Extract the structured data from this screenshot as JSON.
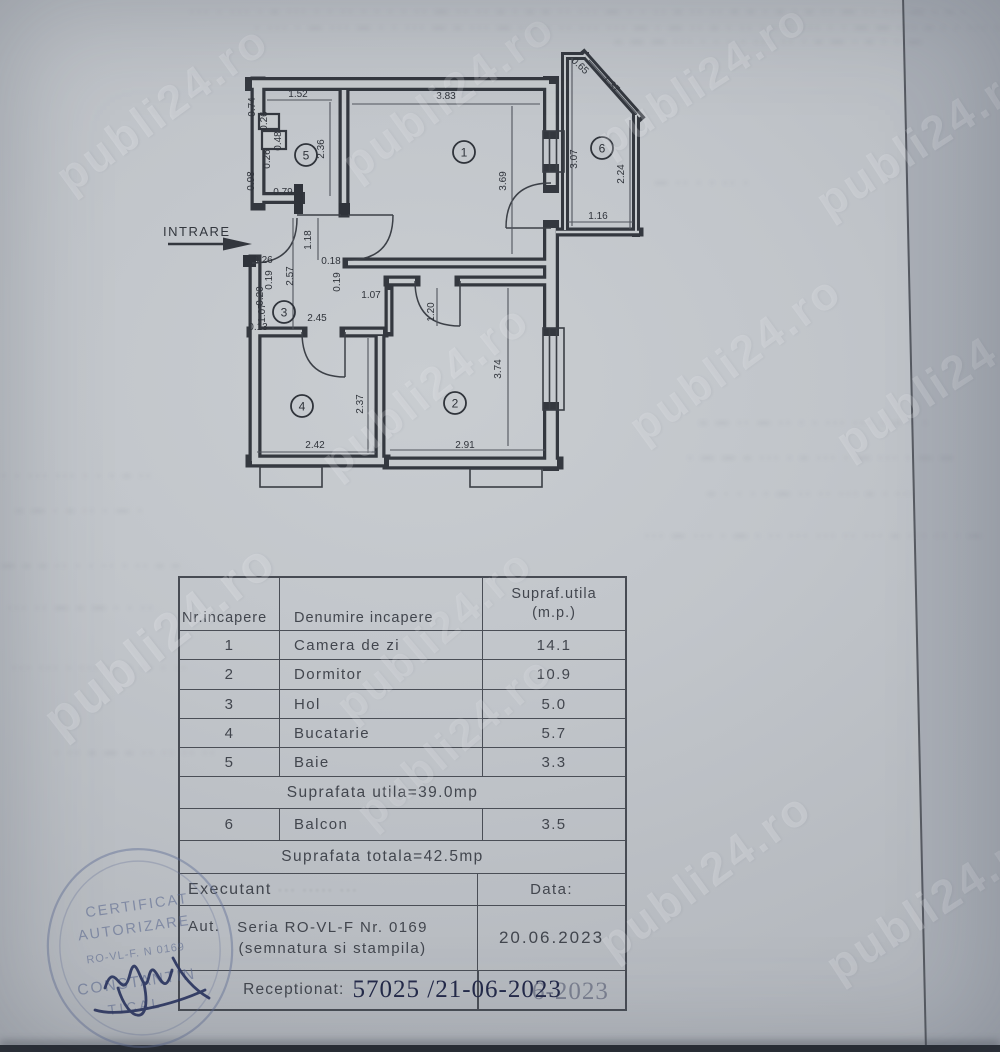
{
  "watermark": {
    "text": "publi24.ro"
  },
  "plan": {
    "entrance_label": "INTRARE",
    "room_circles": [
      {
        "label": "1",
        "x": 464,
        "y": 152
      },
      {
        "label": "2",
        "x": 455,
        "y": 403
      },
      {
        "label": "3",
        "x": 284,
        "y": 312
      },
      {
        "label": "4",
        "x": 302,
        "y": 406
      },
      {
        "label": "5",
        "x": 306,
        "y": 155
      },
      {
        "label": "6",
        "x": 602,
        "y": 148
      }
    ],
    "dim_labels": [
      {
        "t": "1.52",
        "x": 298,
        "y": 97,
        "r": 0
      },
      {
        "t": "0.74",
        "x": 255,
        "y": 107,
        "r": -90
      },
      {
        "t": "0.26",
        "x": 267,
        "y": 121,
        "r": -90
      },
      {
        "t": "0.48",
        "x": 281,
        "y": 141,
        "r": -90
      },
      {
        "t": "0.26",
        "x": 270,
        "y": 159,
        "r": -90
      },
      {
        "t": "0.98",
        "x": 254,
        "y": 181,
        "r": -90
      },
      {
        "t": "0.79",
        "x": 283,
        "y": 195,
        "r": 0
      },
      {
        "t": "2.36",
        "x": 324,
        "y": 149,
        "r": -90
      },
      {
        "t": "3.83",
        "x": 446,
        "y": 99,
        "r": 0
      },
      {
        "t": "3.69",
        "x": 506,
        "y": 181,
        "r": -90
      },
      {
        "t": "0.65",
        "x": 578,
        "y": 68,
        "r": 43
      },
      {
        "t": "1.37",
        "x": 609,
        "y": 86,
        "r": 46
      },
      {
        "t": "3.07",
        "x": 577,
        "y": 159,
        "r": -90
      },
      {
        "t": "2.24",
        "x": 624,
        "y": 174,
        "r": -90
      },
      {
        "t": "1.16",
        "x": 598,
        "y": 219,
        "r": 0
      },
      {
        "t": "1.18",
        "x": 311,
        "y": 240,
        "r": -90
      },
      {
        "t": "0.26",
        "x": 263,
        "y": 263,
        "r": 0
      },
      {
        "t": "0.19",
        "x": 272,
        "y": 280,
        "r": -90
      },
      {
        "t": "2.57",
        "x": 293,
        "y": 276,
        "r": -90
      },
      {
        "t": "0.20",
        "x": 263,
        "y": 296,
        "r": -90
      },
      {
        "t": "1.07",
        "x": 265,
        "y": 313,
        "r": -90
      },
      {
        "t": "0.13",
        "x": 258,
        "y": 330,
        "r": 0
      },
      {
        "t": "0.18",
        "x": 331,
        "y": 264,
        "r": 0
      },
      {
        "t": "0.19",
        "x": 340,
        "y": 282,
        "r": -90
      },
      {
        "t": "1.07",
        "x": 371,
        "y": 298,
        "r": 0
      },
      {
        "t": "2.45",
        "x": 317,
        "y": 321,
        "r": 0
      },
      {
        "t": "1.20",
        "x": 434,
        "y": 312,
        "r": -90
      },
      {
        "t": "2.37",
        "x": 363,
        "y": 404,
        "r": -90
      },
      {
        "t": "2.42",
        "x": 315,
        "y": 448,
        "r": 0
      },
      {
        "t": "2.91",
        "x": 465,
        "y": 448,
        "r": 0
      },
      {
        "t": "3.74",
        "x": 501,
        "y": 369,
        "r": -90
      }
    ]
  },
  "table": {
    "headers": {
      "col1": "Nr.incapere",
      "col2": "Denumire incapere",
      "col3_line1": "Supraf.utila",
      "col3_line2": "(m.p.)"
    },
    "rows": [
      {
        "nr": "1",
        "name": "Camera de zi",
        "area": "14.1"
      },
      {
        "nr": "2",
        "name": "Dormitor",
        "area": "10.9"
      },
      {
        "nr": "3",
        "name": "Hol",
        "area": "5.0"
      },
      {
        "nr": "4",
        "name": "Bucatarie",
        "area": "5.7"
      },
      {
        "nr": "5",
        "name": "Baie",
        "area": "3.3"
      }
    ],
    "suprafata_utila": "Suprafata  utila=39.0mp",
    "balcon_row": {
      "nr": "6",
      "name": "Balcon",
      "area": "3.5"
    },
    "suprafata_totala": "Suprafata  totala=42.5mp",
    "executant_label": "Executant",
    "executant_faded": "··· ····· ···",
    "data_label": "Data:",
    "aut_prefix": "Aut.",
    "aut_line1": "Seria RO-VL-F  Nr.  0169",
    "aut_line2": "(semnatura si stampila)",
    "date_value": "20.06.2023",
    "receptionat_label": "Receptionat:",
    "receptionat_value": "57025 /21-06-2023",
    "receptionat_overprint": "6-2023"
  },
  "stamp": {
    "line1": "CERTIFICAT",
    "line2": "AUTORIZARE",
    "line3": "RO-VL-F. N 0169",
    "line4": "CONSTANTIN",
    "line5": "TICAL"
  }
}
